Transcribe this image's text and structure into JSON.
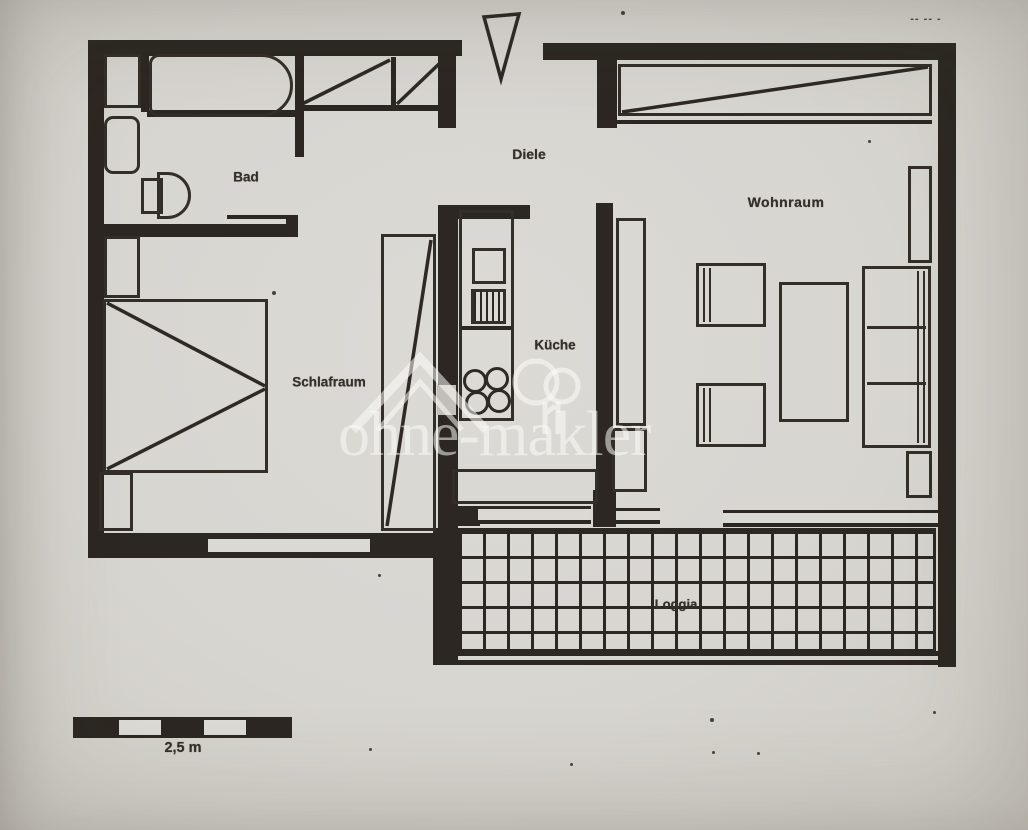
{
  "document": {
    "kind": "scanned-floor-plan-photo",
    "watermark": {
      "text": "ohne-makler",
      "logo": "house-and-tree-icon",
      "opacity": 0.55
    }
  },
  "labels": {
    "bad": "Bad",
    "diele": "Diele",
    "wohnraum": "Wohnraum",
    "schlafraum": "Schlafraum",
    "kueche": "Küche",
    "loggia": "Loggia",
    "scale": "2,5 m",
    "handwritten_marks": "-- -- -"
  },
  "colors": {
    "paper": "#d7d5d0",
    "ink": "#2c2722",
    "watermark": "#fbfbf8"
  },
  "fixtures": [
    "entrance-arrow",
    "hall-wardrobe",
    "bathtub",
    "shower-tray",
    "washbasin",
    "toilet",
    "bed",
    "nightstand",
    "bedroom-wardrobe",
    "kitchen-unit",
    "sink",
    "drainer",
    "hob-burners",
    "kitchen-counter",
    "living-wardrobe",
    "shelf",
    "cabinet",
    "armchair",
    "coffee-table",
    "sofa",
    "side-table",
    "loggia-tile-grid",
    "loggia-railing",
    "scale-bar"
  ]
}
